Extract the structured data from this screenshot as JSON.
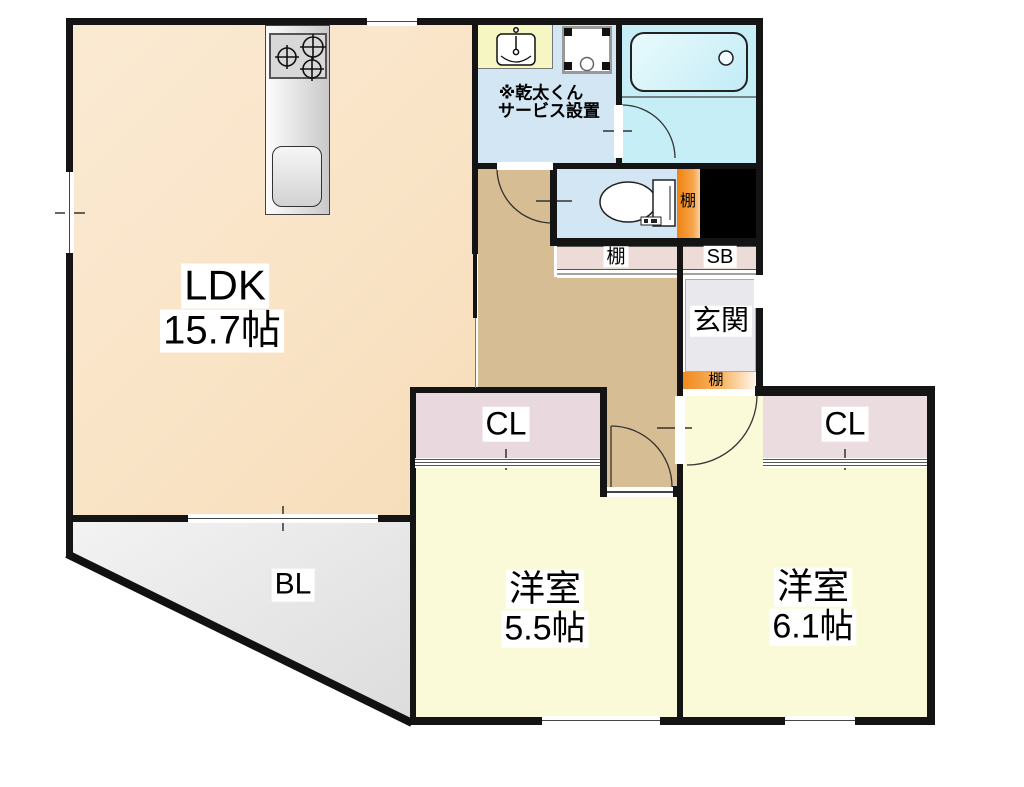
{
  "floorplan": {
    "rooms": {
      "ldk": {
        "name": "LDK",
        "size": "15.7帖"
      },
      "bedroom_left": {
        "name": "洋室",
        "size": "5.5帖"
      },
      "bedroom_right": {
        "name": "洋室",
        "size": "6.1帖"
      },
      "balcony": {
        "label": "BL"
      },
      "entrance": {
        "label": "玄関"
      },
      "closet_left": {
        "label": "CL"
      },
      "closet_right": {
        "label": "CL"
      },
      "shoe_box": {
        "label": "SB"
      },
      "shelf_toilet": {
        "label": "棚"
      },
      "shelf_hall": {
        "label": "棚"
      },
      "shelf_entrance": {
        "label": "棚"
      }
    },
    "notes": {
      "dryer_service": {
        "line1": "※乾太くん",
        "line2": "サービス設置"
      }
    },
    "icons": [
      "stove-burners-icon",
      "kitchen-sink-icon",
      "vanity-basin-icon",
      "washer-pan-icon",
      "bathtub-icon",
      "toilet-icon",
      "door-swing-arc",
      "window-slot"
    ],
    "colors": {
      "ldk": "#F9E3C5",
      "hallway": "#D7BD93",
      "bedroom": "#FAFAD8",
      "closet": "#E9D8DD",
      "shelf_strip": "#ECDBD7",
      "entrance_floor": "#E9E9ED",
      "washroom": "#D2E6F3",
      "bathroom": "#C6EEF7",
      "shelf_orange": "#F18A1F",
      "balcony": "#EAEAEA",
      "void": "#000000",
      "wall": "#141414"
    }
  }
}
